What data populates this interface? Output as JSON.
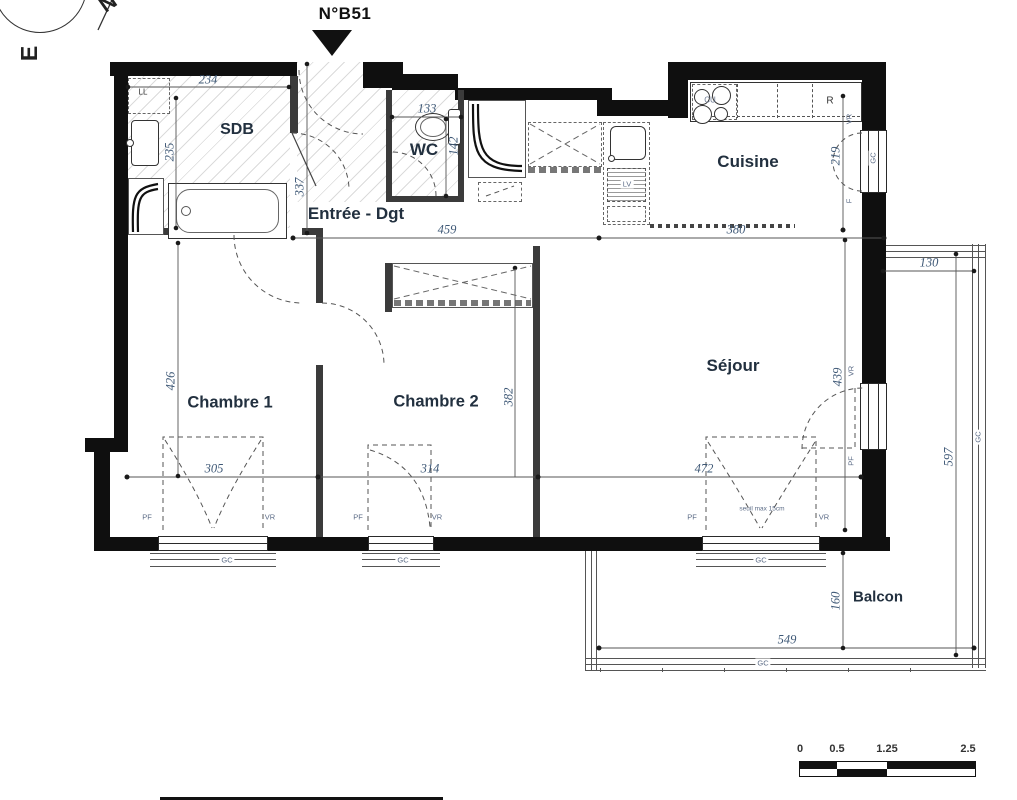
{
  "header": {
    "unit": "N°B51"
  },
  "compass": {
    "n": "N",
    "e": "E"
  },
  "rooms": {
    "sdb": "SDB",
    "wc": "WC",
    "entree": "Entrée - Dgt",
    "cuisine": "Cuisine",
    "ch1": "Chambre 1",
    "ch2": "Chambre 2",
    "sejour": "Séjour",
    "balcon": "Balcon"
  },
  "dims": {
    "d234": "234",
    "d235": "235",
    "d337": "337",
    "d133": "133",
    "d142": "142",
    "d459": "459",
    "d380": "380",
    "d219": "219",
    "d130": "130",
    "d426": "426",
    "d305": "305",
    "d314": "314",
    "d472": "472",
    "d382": "382",
    "d439": "439",
    "d597": "597",
    "d160": "160",
    "d549": "549"
  },
  "fixtures": {
    "ll": "LL",
    "cu": "CU",
    "r": "R",
    "lv": "LV"
  },
  "labels": {
    "pf": "PF",
    "vr": "VR",
    "gc": "GC",
    "f": "F",
    "seuil": "seuil max 15cm"
  },
  "scalebar": {
    "t0": "0",
    "t1": "0.5",
    "t2": "1.25",
    "t3": "2.5"
  }
}
